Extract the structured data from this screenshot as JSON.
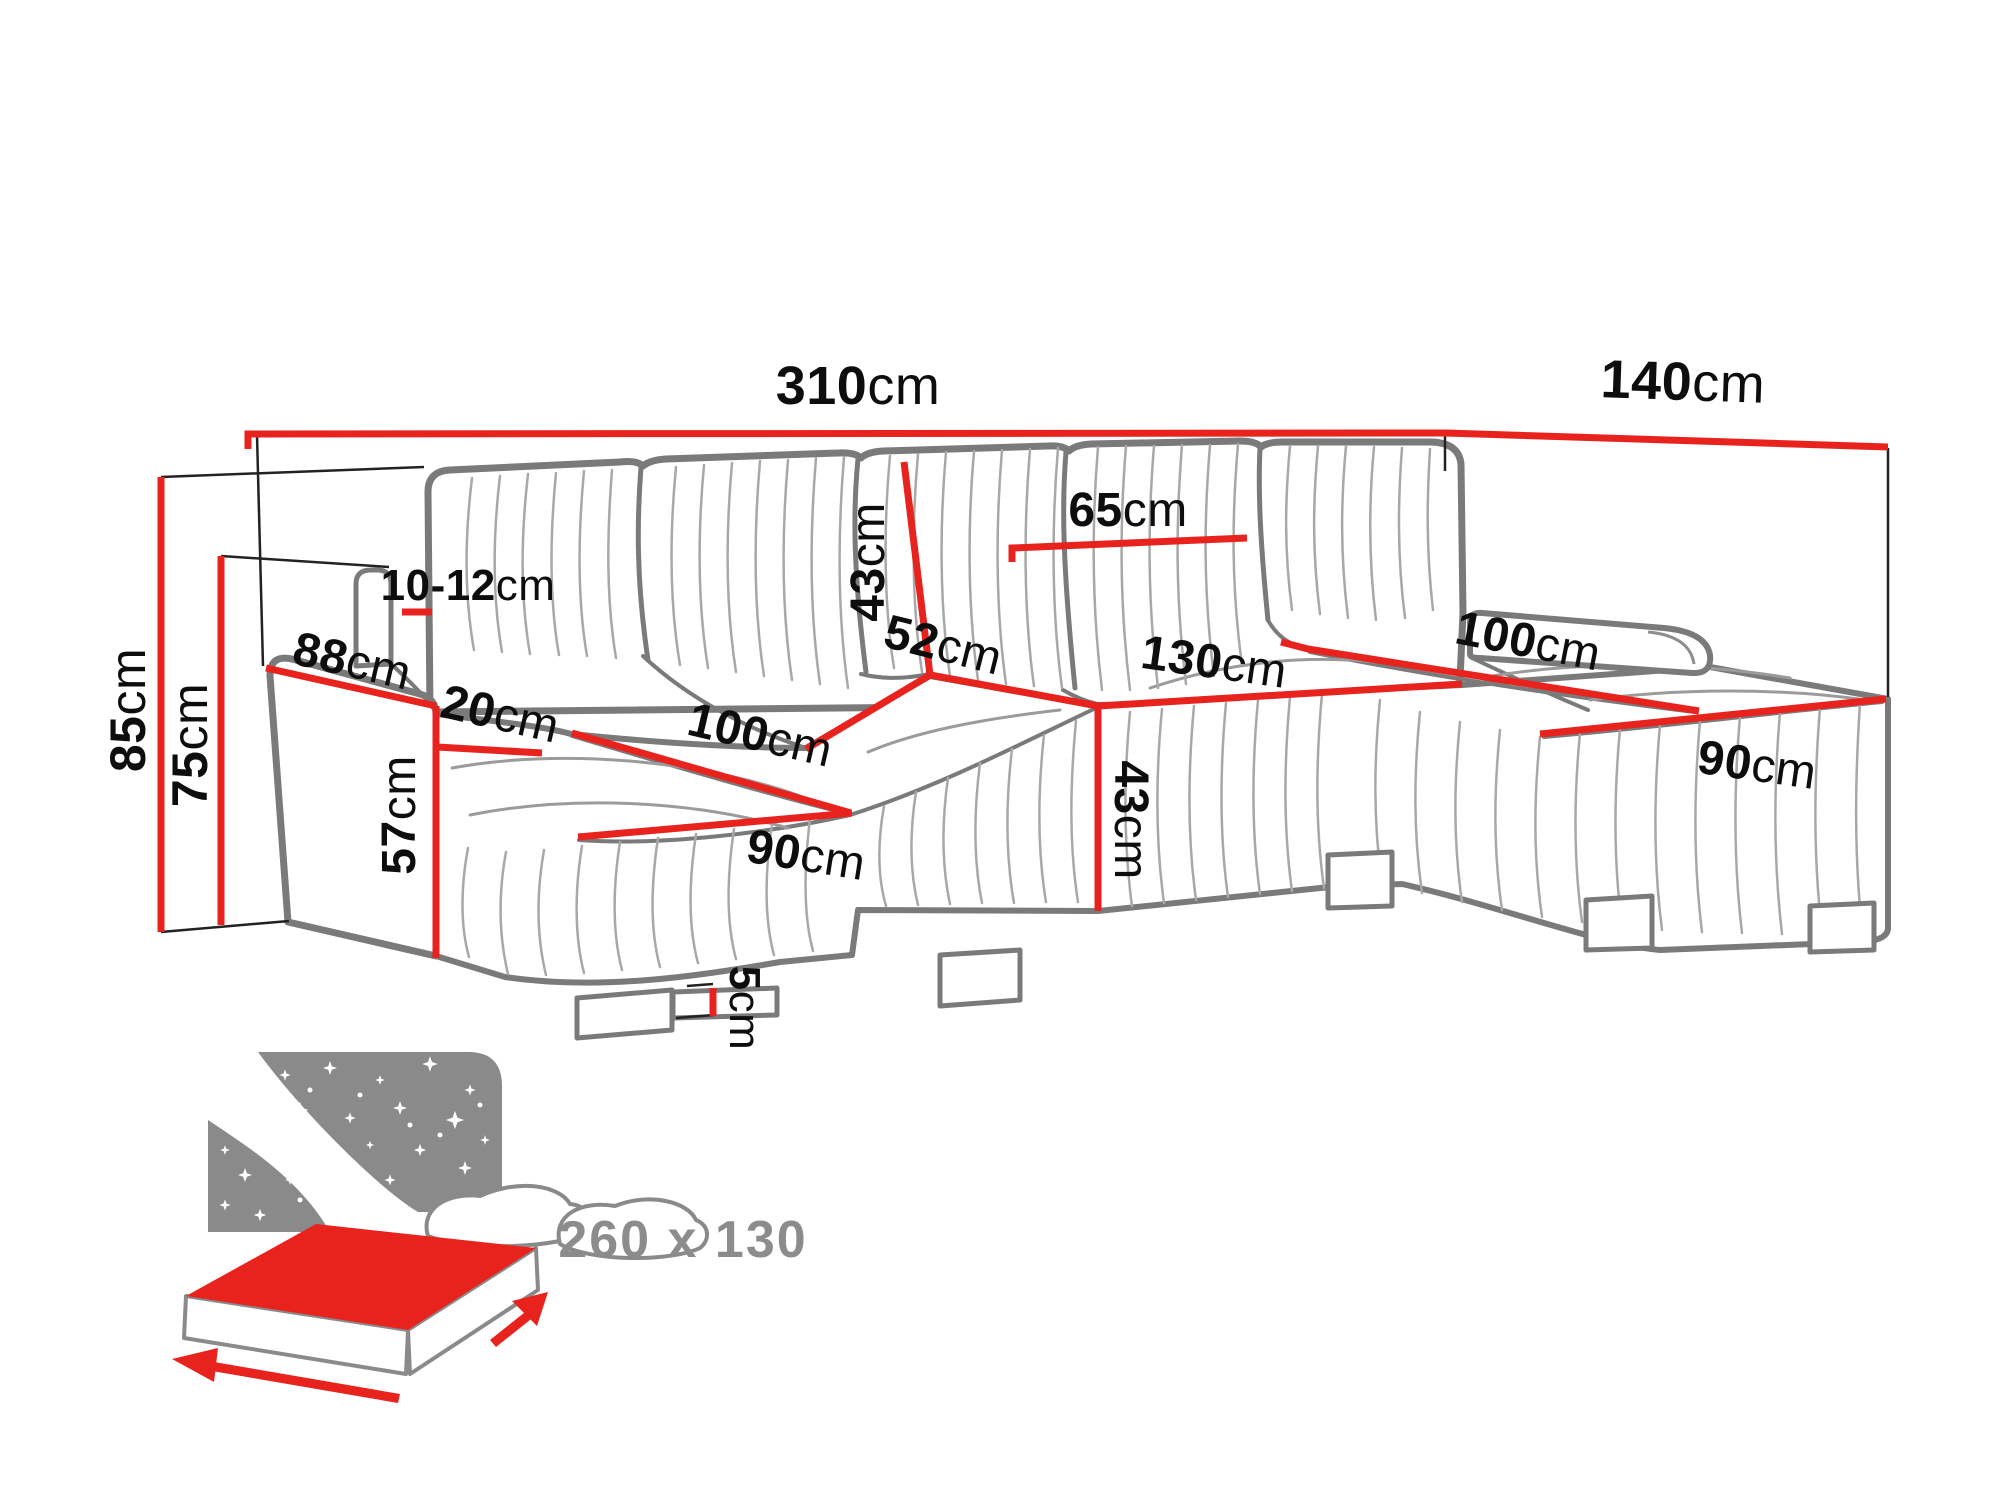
{
  "diagram": {
    "title": "corner-sofa-dimension-diagram",
    "unit": "cm",
    "colors": {
      "dimension_red": "#e8231e",
      "outline_gray": "#7a7a7a",
      "pleat_gray": "#a8a8a8",
      "label_black": "#0d0d0d",
      "sleep_gray": "#8c8c8c"
    },
    "labels": {
      "total_width": {
        "num": "310",
        "unit": "cm"
      },
      "right_depth": {
        "num": "140",
        "unit": "cm"
      },
      "height_total": {
        "num": "85",
        "unit": "cm"
      },
      "height_backrest": {
        "num": "75",
        "unit": "cm"
      },
      "arm_outer_length": {
        "num": "88",
        "unit": "cm"
      },
      "headrest_band": {
        "num": "10-12",
        "unit": "cm"
      },
      "armrest_width": {
        "num": "20",
        "unit": "cm"
      },
      "chaise_left_length": {
        "num": "100",
        "unit": "cm"
      },
      "chaise_left_width": {
        "num": "90",
        "unit": "cm"
      },
      "seat_height": {
        "num": "57",
        "unit": "cm"
      },
      "backrest_height": {
        "num": "43",
        "unit": "cm"
      },
      "back_cushion_width": {
        "num": "65",
        "unit": "cm"
      },
      "seat_depth": {
        "num": "52",
        "unit": "cm"
      },
      "middle_seat_width": {
        "num": "130",
        "unit": "cm"
      },
      "seat_front_height": {
        "num": "43",
        "unit": "cm"
      },
      "chaise_right_length": {
        "num": "100",
        "unit": "cm"
      },
      "chaise_right_width": {
        "num": "90",
        "unit": "cm"
      },
      "leg_height": {
        "num": "5",
        "unit": "cm"
      },
      "sleeping_area": "260 x 130"
    }
  }
}
